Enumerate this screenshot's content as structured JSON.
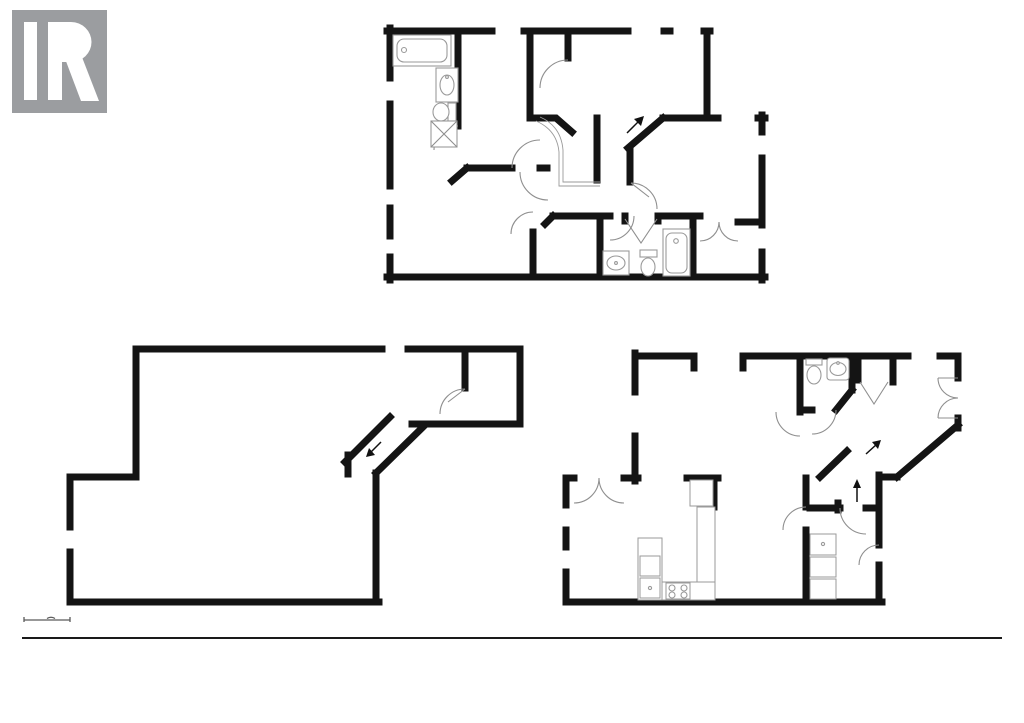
{
  "branding": {
    "logo_text": "REALTOR",
    "logo_reg": "®",
    "licensed_to": "Licensed to CAOR"
  },
  "scale_bar": {
    "zero": "0'",
    "five": "5'"
  },
  "footer": {
    "area_note": "FLOOR PLAN AREA 3,085 sq.ft.",
    "disclaimer1": "APPROXIMATE SQUARE FOOTAGE",
    "disclaimer2": "ALL DRAWINGS ARE FOR ILLUSTRATIVE PURPOSES ONLY",
    "address": "518 SANDCHERRY DRIVE, BURLINGTON, ON"
  },
  "second_level": {
    "label": "SECOND LEVEL",
    "bath_left": [
      "BATH",
      "7'3\" x 13'4\"",
      "(2.20m x 4.07m)"
    ],
    "bedroom_top": [
      "BEDROOM",
      "10'10\" x 13'4\"",
      "(3.31m x 4.07m)"
    ],
    "wic_top": "W.I.C.",
    "open_to_below": "OPEN TO BELOW",
    "bedroom_right": [
      "BEDROOM",
      "15'1\" x 12'7\"",
      "(4.59m x 3.84m)"
    ],
    "primary_bedroom": [
      "PRIMARY BEDROOM",
      "15'8\" x 13'10\"",
      "(4.77m x 4.23m)"
    ],
    "wic_primary": "W.I.C.",
    "bath_ensuite": [
      "BATH",
      "10'1\" x 6'7\"",
      "(3.07m x 2.01m)"
    ],
    "closet": "CL",
    "wic_right": "W.I.C."
  },
  "basement_level": {
    "label": "BASEMENT",
    "basement": [
      "BASEMENT",
      "37'0\" x 28'11\"",
      "(11.28m x 8.82m)"
    ],
    "storage": "STORAGE"
  },
  "main_level": {
    "label": "MAIN LEVEL",
    "living_room": [
      "LIVING ROOM",
      "18'10\" x 13'4\"",
      "(5.79m x 4.07m)"
    ],
    "bath": "BATH",
    "closet": "CL",
    "foyer": [
      "FOYER",
      "11'5\" x 8'8\"",
      "(3.48m x 2.65m)"
    ],
    "breakfast": [
      "BREAKFAST",
      "8'2\" x 13'11\"",
      "(2.48m x 4.25m)"
    ],
    "kitchen": [
      "KITCHEN",
      "8'7\" x 13'11\"",
      "(2.61m x 4.25m)"
    ],
    "dining_room": [
      "DINING ROOM",
      "9'5\" x 14'8\"",
      "(2.87m x 4.47m)"
    ],
    "laundry": [
      "LAUNDRY",
      "7'10\" x 10'6\"",
      "(2.39m x 3.20m)"
    ],
    "fridge": "REF",
    "dishwasher": "DW",
    "dryer": "D",
    "washer": "W"
  },
  "colors": {
    "wall": "#141414",
    "fixture_line": "#8f8f8f",
    "label_gray": "#57585a",
    "logo_gray": "#9b9da0",
    "watermark_gray": "#c9c9c9",
    "footer_gray": "#8f8f8f",
    "address_dark": "#3d3d3d"
  }
}
